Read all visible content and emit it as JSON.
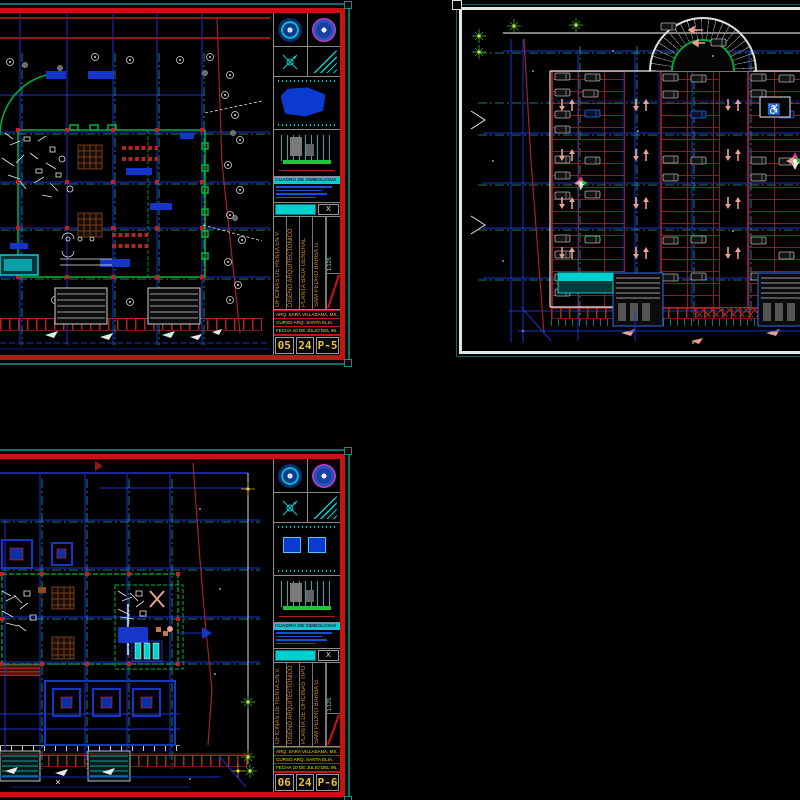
{
  "colors": {
    "frame_teal": "#166a6a",
    "border_red": "#c41414",
    "border_white": "#e6e6e6",
    "grid_blue": "#1c35d0",
    "centerline_teal": "#1f9e9e",
    "outline_green": "#00b33c",
    "stall_red": "#a22424",
    "survey_red": "#a22424",
    "car_gray": "#b0b0b0",
    "arrow_salmon": "#e8a090",
    "title_text_orange": "#d9882a",
    "number_yellow": "#e8c23a",
    "legend_cyan": "#00cfcf"
  },
  "icons": {
    "wheelchair": "♿"
  },
  "sheets": {
    "ground": {
      "title_block": {
        "project": "OFICINAS DE RENTA EN V.",
        "course": "DISEÑO ARQUITECTONICO",
        "drawing": "PLANTA BAJA GENERAL",
        "author": "SAM PEDRO BARBA G.",
        "scale": "1:125",
        "x_mark": "X",
        "legend_title": "CUADRO DE SIMBOLOGIA",
        "info_rows": [
          "ARQ. SARA VILLASANA, MX.",
          "CURSO ARQ. SANTA ELIA.",
          "FECHA 10 DE JULIO DEL 96."
        ],
        "sheet_no": [
          "05",
          "24",
          "P-5"
        ]
      }
    },
    "offices": {
      "title_block": {
        "project": "OFICINAS DE RENTA EN V.",
        "course": "DISEÑO ARQUITECTONICO",
        "drawing": "PLANTA DE OFICINAS TIPO",
        "author": "SAM PEDRO BARBA G.",
        "scale": "1:125",
        "x_mark": "X",
        "legend_title": "CUADRO DE SIMBOLOGIA",
        "info_rows": [
          "ARQ. SARA VILLASANA, MX.",
          "CURSO ARQ. SANTA ELIA.",
          "FECHA 10 DE JULIO DEL 96."
        ],
        "sheet_no": [
          "06",
          "24",
          "P-6"
        ]
      }
    }
  }
}
